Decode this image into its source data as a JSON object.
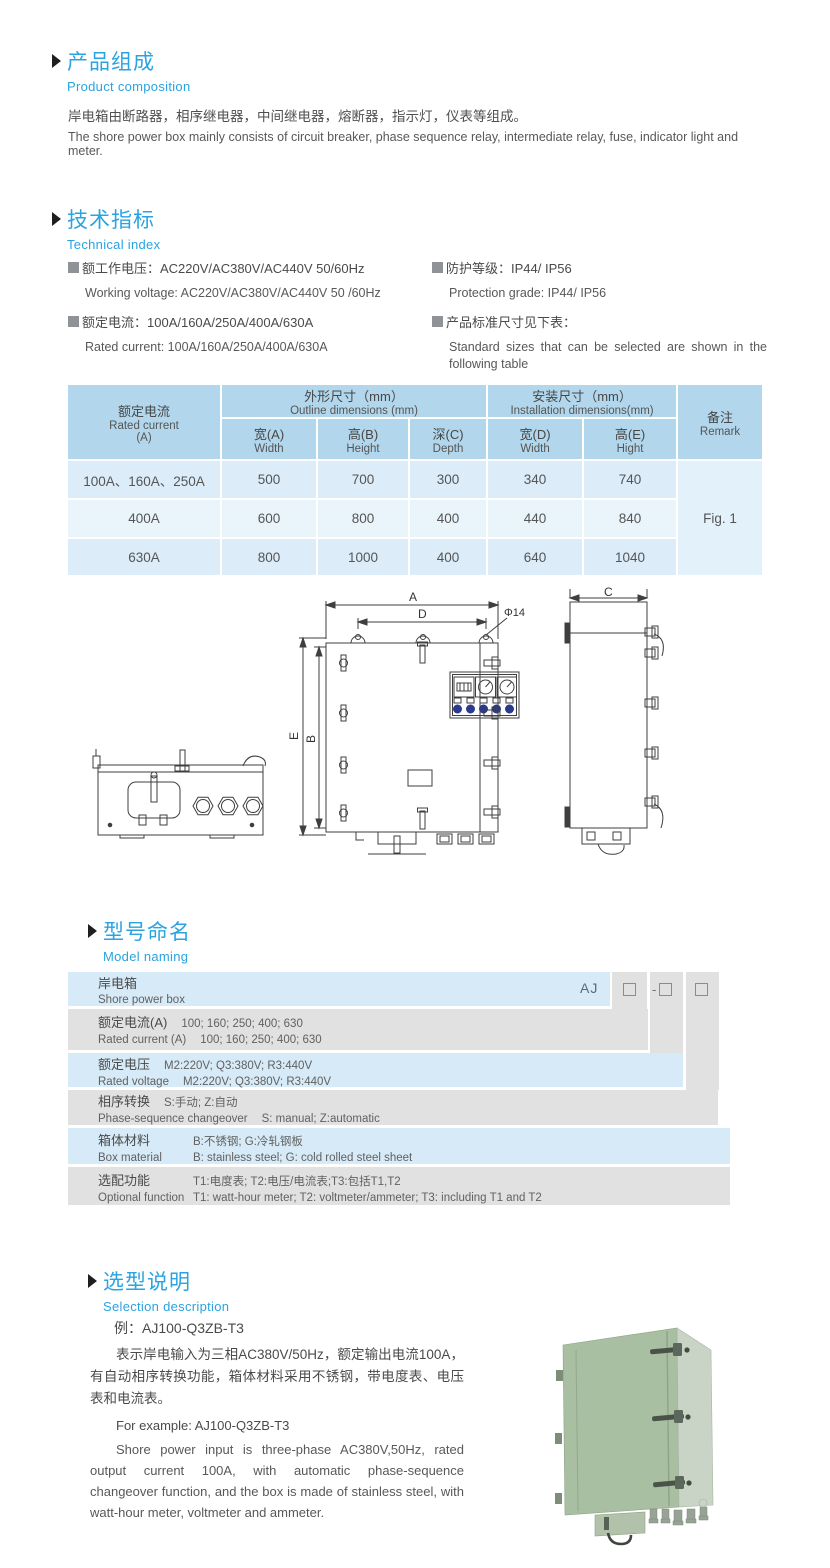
{
  "colors": {
    "accent": "#2aa3e0",
    "text": "#4f4f4f",
    "table_header_bg": "#b2d7ec",
    "table_row_light": "#dcecf8",
    "table_row_lighter": "#e9f4fb",
    "naming_blue": "#d6eaf7",
    "naming_grey": "#e1e1e1",
    "indicator_blue": "#2b3a8c",
    "product_front_green": "#a9bfa2",
    "product_side_green": "#c9d3c6"
  },
  "composition": {
    "title_zh": "产品组成",
    "title_en": "Product  composition",
    "para_zh": "岸电箱由断路器，相序继电器，中间继电器，熔断器，指示灯，仪表等组成。",
    "para_en": "The shore power box mainly consists of circuit breaker, phase sequence relay, intermediate relay, fuse, indicator light and meter."
  },
  "technical": {
    "title_zh": "技术指标",
    "title_en": "Technical index",
    "left": [
      {
        "zh": "额工作电压：AC220V/AC380V/AC440V  50/60Hz",
        "en": "Working voltage: AC220V/AC380V/AC440V 50 /60Hz"
      },
      {
        "zh": "额定电流：100A/160A/250A/400A/630A",
        "en": "Rated current: 100A/160A/250A/400A/630A"
      }
    ],
    "right": [
      {
        "zh": "防护等级：IP44/ IP56",
        "en": "Protection grade: IP44/ IP56"
      },
      {
        "zh": "产品标准尺寸见下表：",
        "en": "Standard sizes that can be selected are shown in the following table"
      }
    ]
  },
  "dims_table": {
    "rated_zh": "额定电流",
    "rated_en": "Rated current",
    "rated_unit": "(A)",
    "outline_zh": "外形尺寸（mm）",
    "outline_en": "Outline dimensions (mm)",
    "install_zh": "安装尺寸（mm）",
    "install_en": "Installation dimensions(mm)",
    "remark_zh": "备注",
    "remark_en": "Remark",
    "sub": [
      {
        "zh": "宽(A)",
        "en": "Width"
      },
      {
        "zh": "高(B)",
        "en": "Height"
      },
      {
        "zh": "深(C)",
        "en": "Depth"
      },
      {
        "zh": "宽(D)",
        "en": "Width"
      },
      {
        "zh": "高(E)",
        "en": "Hight"
      }
    ],
    "rows": [
      {
        "current": "100A、160A、250A",
        "a": "500",
        "b": "700",
        "c": "300",
        "d": "340",
        "e": "740"
      },
      {
        "current": "400A",
        "a": "600",
        "b": "800",
        "c": "400",
        "d": "440",
        "e": "840"
      },
      {
        "current": "630A",
        "a": "800",
        "b": "1000",
        "c": "400",
        "d": "640",
        "e": "1040"
      }
    ],
    "remark_value": "Fig. 1"
  },
  "drawing": {
    "dim_a": "A",
    "dim_b": "B",
    "dim_c": "C",
    "dim_d": "D",
    "dim_e": "E",
    "hole_label": "Φ14"
  },
  "naming": {
    "title_zh": "型号命名",
    "title_en": "Model naming",
    "code_prefix": "AJ",
    "code_dash": "-",
    "rows": [
      {
        "zh": "岸电箱",
        "en": "Shore power box",
        "zh_val": "",
        "en_val": ""
      },
      {
        "zh": "额定电流(A)",
        "zh_val": "100; 160; 250; 400; 630",
        "en": "Rated current (A)",
        "en_val": "100; 160; 250; 400; 630"
      },
      {
        "zh": "额定电压",
        "zh_val": "M2:220V;  Q3:380V;  R3:440V",
        "en": "Rated voltage",
        "en_val": "M2:220V;  Q3:380V;  R3:440V"
      },
      {
        "zh": "相序转换",
        "zh_val": "S:手动; Z:自动",
        "en": "Phase-sequence changeover",
        "en_val": "S: manual;  Z:automatic"
      },
      {
        "zh": "箱体材料",
        "zh_val": "B:不锈钢;  G:冷轧钢板",
        "en": "Box material",
        "en_val": "B: stainless steel; G: cold rolled steel sheet"
      },
      {
        "zh": "选配功能",
        "zh_val": "T1:电度表;  T2:电压/电流表;T3:包括T1,T2",
        "en": "Optional function",
        "en_val": "T1: watt-hour meter; T2: voltmeter/ammeter; T3: including T1 and T2"
      }
    ]
  },
  "selection": {
    "title_zh": "选型说明",
    "title_en": "Selection description",
    "example_zh": "例：AJ100-Q3ZB-T3",
    "para_zh": "表示岸电输入为三相AC380V/50Hz，额定输出电流100A，有自动相序转换功能，箱体材料采用不锈钢，带电度表、电压表和电流表。",
    "example_en": "For example: AJ100-Q3ZB-T3",
    "para_en": "Shore power input is three-phase AC380V,50Hz, rated output current 100A, with automatic phase-sequence changeover function, and the box is made of stainless steel, with watt-hour meter, voltmeter and ammeter."
  }
}
